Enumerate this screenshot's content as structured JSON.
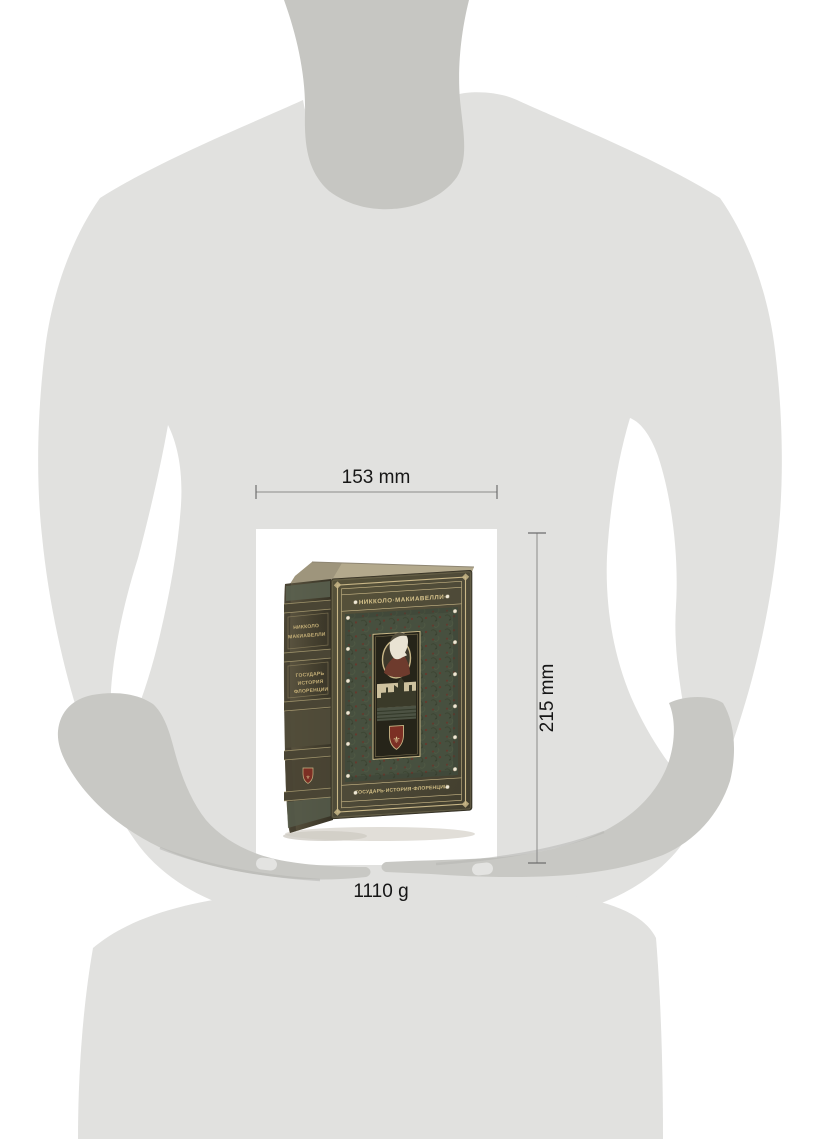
{
  "dimensions": {
    "width_label": "153 mm",
    "height_label": "215 mm",
    "weight_label": "1110 g"
  },
  "book": {
    "cover_title": "·НИККОЛО·МАКИАВЕЛЛИ·",
    "cover_motto": "·ГОСУДАРЬ·ИСТОРИЯ·ФЛОРЕНЦИИ·",
    "spine": {
      "author_lines": [
        "НИККОЛО",
        "МАКИАВЕЛЛИ"
      ],
      "title_lines": [
        "ГОСУДАРЬ",
        "ИСТОРИЯ",
        "ФЛОРЕНЦИИ"
      ]
    },
    "shield_glyph": "⚜"
  },
  "colors": {
    "background": "#ffffff",
    "body": "#e1e1df",
    "skin": "#c6c6c2",
    "sleeve": "#c8c8c4",
    "thumbnail": "#e3e3e1",
    "photo_background": "#ffffff",
    "leather_field": "#47503f",
    "gold": "#c9b787",
    "accent_red": "#7c2f24",
    "dimension_line": "#8a8a8a"
  }
}
